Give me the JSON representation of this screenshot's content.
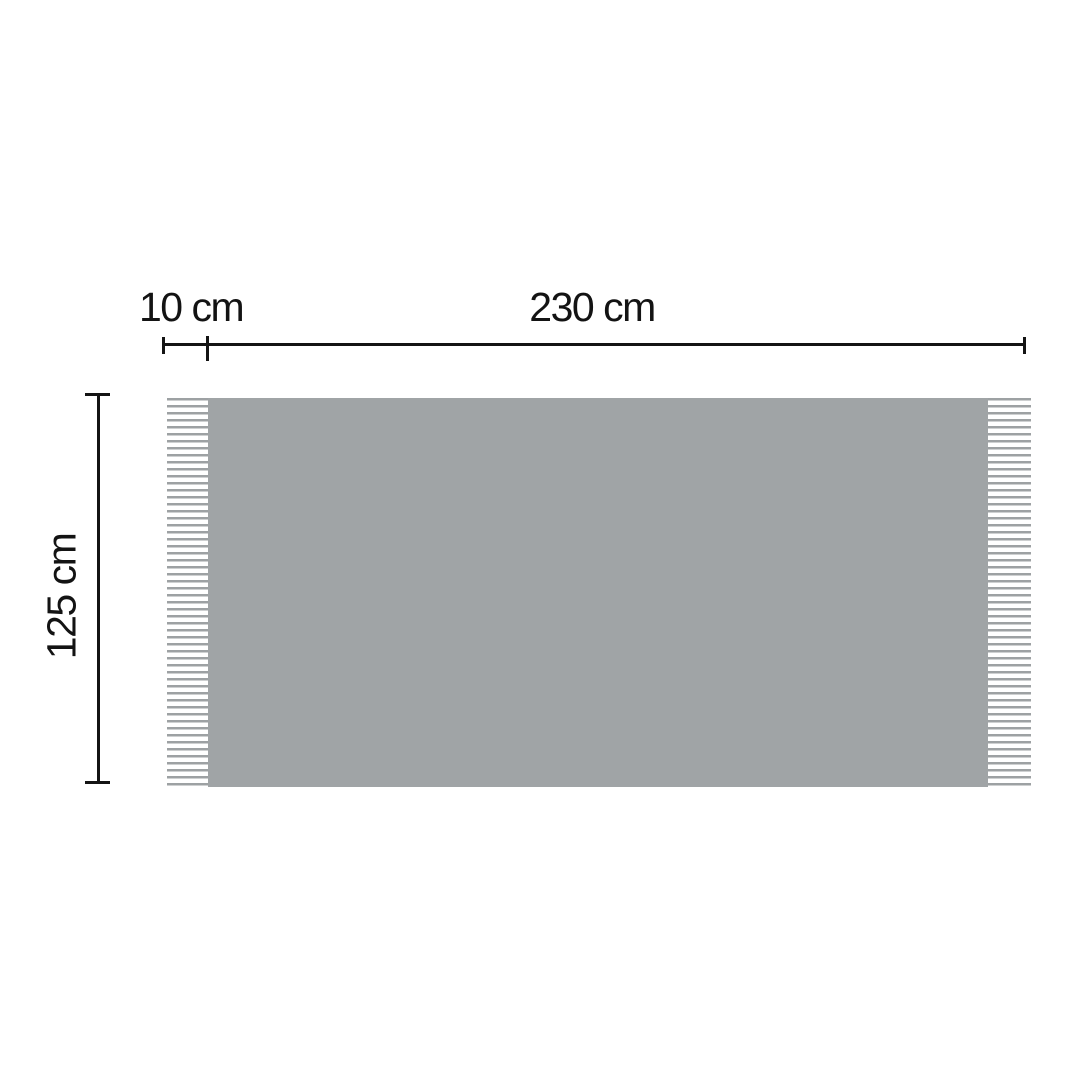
{
  "diagram": {
    "kind": "blanket-dimension-diagram",
    "dimensions": {
      "fringe_width_label": "10 cm",
      "total_width_label": "230 cm",
      "height_label": "125 cm"
    },
    "colors": {
      "background": "#ffffff",
      "blanket_fill": "#a0a4a6",
      "fringe_strand": "#9da1a3",
      "dimension_line": "#141414",
      "label_text": "#131313"
    }
  }
}
